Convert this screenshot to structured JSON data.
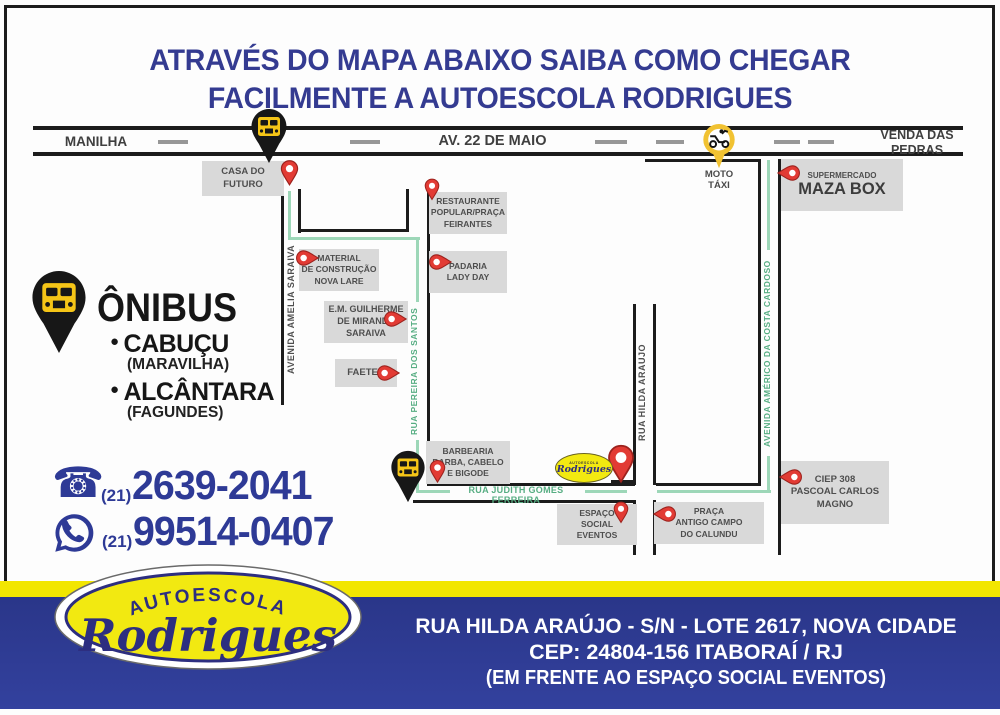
{
  "title": {
    "line1": "ATRAVÉS DO MAPA ABAIXO SAIBA COMO CHEGAR",
    "line2": "FACILMENTE A AUTOESCOLA RODRIGUES"
  },
  "map": {
    "road": {
      "left": "MANILHA",
      "center": "AV. 22 DE MAIO",
      "right": "VENDA DAS\nPEDRAS"
    },
    "moto_taxi": "MOTO\nTÁXI",
    "streets": {
      "amelia": "AVENIDA AMELIA SARAIVA",
      "pereira": "RUA PEREIRA DOS SANTOS",
      "judith": "RUA JUDITH GOMES FERREIRA",
      "hilda": "RUA HILDA ARAUJO",
      "americo": "AVENIDA AMÉRICO DA COSTA CARDOSO"
    },
    "locations": {
      "casa": "CASA DO\nFUTURO",
      "restaurante": "RESTAURANTE\nPOPULAR/PRAÇA\nFEIRANTES",
      "material": "MATERIAL\nDE CONSTRUÇÃO\nNOVA LARE",
      "padaria": "PADARIA\nLADY DAY",
      "escola": "E.M. GUILHERME\nDE MIRANDA\nSARAIVA",
      "faetec": "FAETEC",
      "barbearia": "BARBEARIA\nBARBA, CABELO\nE BIGODE",
      "maza_top": "SUPERMERCADO",
      "maza_name": "MAZA BOX",
      "ciep": "CIEP 308\nPASCOAL CARLOS\nMAGNO",
      "praca": "PRAÇA\nANTIGO CAMPO\nDO CALUNDU",
      "espaco": "ESPAÇO\nSOCIAL\nEVENTOS"
    },
    "mini_logo": {
      "top": "AUTOESCOLA",
      "name": "Rodrigues"
    }
  },
  "legend": {
    "title": "ÔNIBUS",
    "items": [
      {
        "name": "CABUÇU",
        "sub": "(MARAVILHA)"
      },
      {
        "name": "ALCÂNTARA",
        "sub": "(FAGUNDES)"
      }
    ]
  },
  "contact": {
    "phone": {
      "area": "(21)",
      "number": "2639-2041"
    },
    "whatsapp": {
      "area": "(21)",
      "number": "99514-0407"
    }
  },
  "footer": {
    "logo": {
      "top": "AUTOESCOLA",
      "name": "Rodrigues"
    },
    "address1": "RUA HILDA ARAÚJO - S/N - LOTE 2617, NOVA CIDADE",
    "address2": "CEP: 24804-156 ITABORAÍ / RJ",
    "address3": "(EM FRENTE AO ESPAÇO SOCIAL EVENTOS)"
  },
  "icons": {
    "bullet": "●",
    "phone": "☎"
  },
  "colors": {
    "title_blue": "#343b91",
    "banner_blue": "#2b3990",
    "stripe_yellow": "#f2e600",
    "logo_yellow": "#f2e911",
    "route_green": "#9dd7b8",
    "street_name_green": "#56ad82",
    "box_gray": "#d9d9d9",
    "pin_red": "#e23b34",
    "pin_black": "#171717",
    "bus_yellow": "#f5c517"
  }
}
